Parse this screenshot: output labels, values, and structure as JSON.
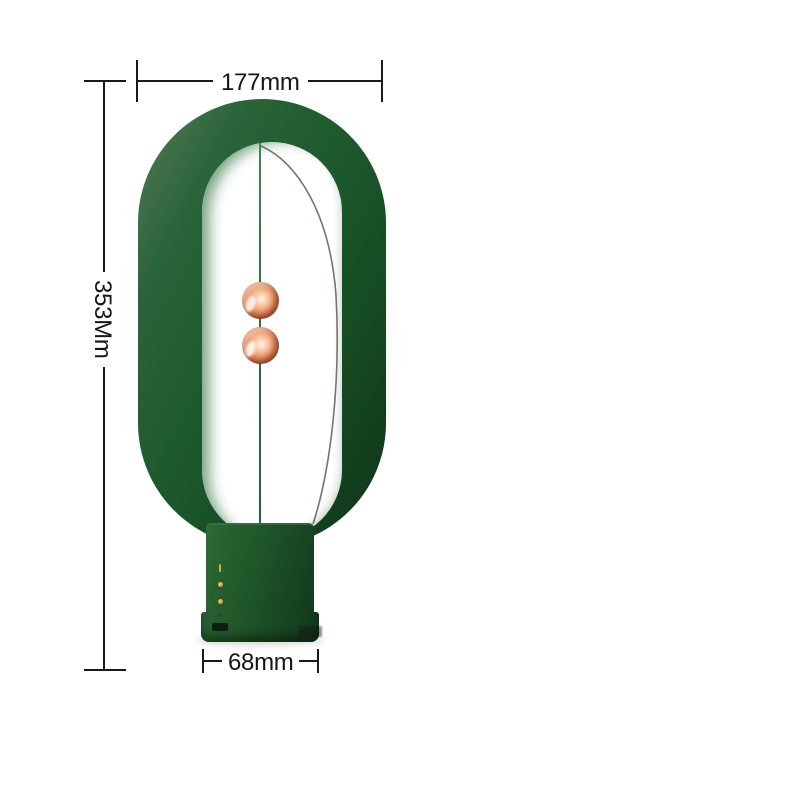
{
  "annotations": {
    "width": "177mm",
    "height": "353Mm",
    "base_width": "68mm"
  },
  "product": {
    "parts": {
      "ring": "green stadium ring frame",
      "balls": "two copper magnetic spheres on center string",
      "base": "green cylindrical base with led indicators and port"
    }
  },
  "colors": {
    "background": "#ffffff",
    "ring_green": "#1d5a2c",
    "ring_highlight": "#6b7d6e",
    "ring_shadow": "#0f3517",
    "ball_copper": "#f3b188",
    "indicator_gold": "#d8ab52",
    "dimension_line": "#1a1a1a"
  }
}
